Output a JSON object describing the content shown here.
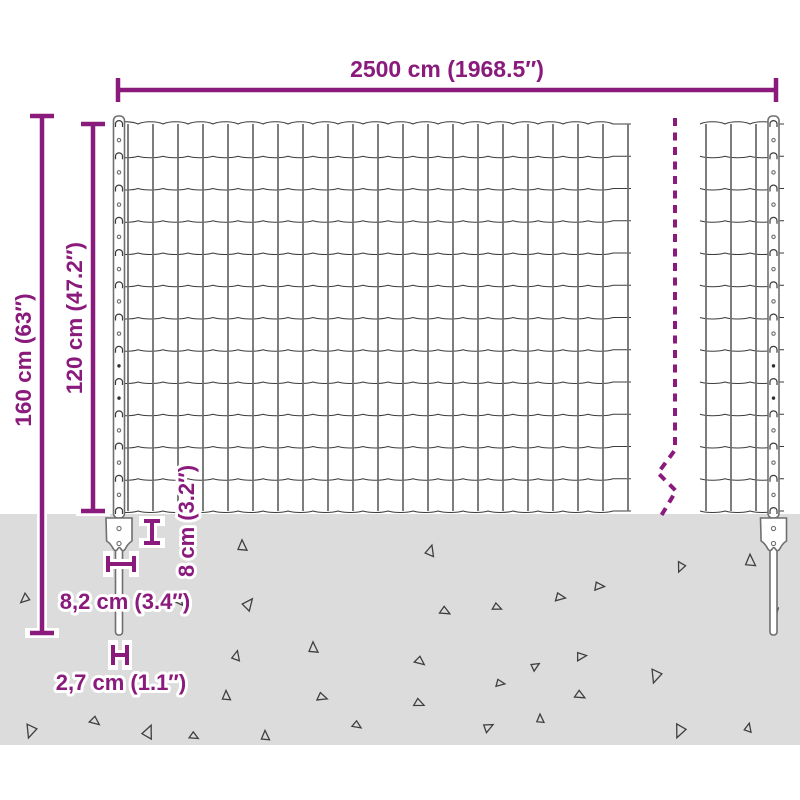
{
  "labels": {
    "width": "2500 cm (1968.5″)",
    "total_height": "160 cm (63″)",
    "fence_height": "120 cm (47.2″)",
    "anchor_height": "8 cm (3.2″)",
    "anchor_width": "8,2 cm (3.4″)",
    "post_width": "2,7 cm (1.1″)"
  },
  "colors": {
    "accent": "#8a1a7c",
    "ground": "#dcdcdc",
    "wire_dark": "#3c3c3c",
    "wire_light": "#6f6f6f",
    "triangle_outline": "#3f3f3f"
  },
  "diagram": {
    "ground": {
      "top": 514,
      "bottom": 745
    },
    "mesh": {
      "top": 124,
      "bottom": 511,
      "rows": 12,
      "cell_width": 25,
      "left": {
        "start": 113,
        "end": 631,
        "first_vertical": 128,
        "vertical_count": 21
      },
      "right": {
        "start": 700,
        "end": 784,
        "verticals": [
          706,
          731,
          756
        ]
      }
    },
    "posts": {
      "centers": [
        119,
        773.5
      ],
      "width": 11,
      "top": 116,
      "above_ground_bottom": 518,
      "spike_top": 540,
      "spike_bottom": 635,
      "spike_width": 7,
      "plate_top": 518,
      "plate_half_width": 13,
      "filled_hole_rows": [
        7,
        8
      ]
    },
    "break_line": {
      "points": "675,118 675,450 658,473 676,491 661,516",
      "dash": "8 6.5"
    },
    "triangles": [
      [
        242,
        546,
        10,
        0
      ],
      [
        430,
        551,
        10,
        18
      ],
      [
        681,
        567,
        9,
        205
      ],
      [
        750,
        561,
        11,
        0
      ],
      [
        599,
        586,
        9,
        95
      ],
      [
        560,
        597,
        9,
        100
      ],
      [
        25,
        599,
        9,
        230
      ],
      [
        248,
        604,
        11,
        40
      ],
      [
        445,
        611,
        9,
        120
      ],
      [
        497,
        607,
        8,
        115
      ],
      [
        180,
        602,
        7,
        140
      ],
      [
        236,
        656,
        9,
        15
      ],
      [
        313,
        648,
        10,
        0
      ],
      [
        420,
        661,
        9,
        130
      ],
      [
        535,
        666,
        8,
        60
      ],
      [
        581,
        656,
        9,
        85
      ],
      [
        656,
        676,
        12,
        200
      ],
      [
        500,
        683,
        8,
        100
      ],
      [
        226,
        696,
        9,
        0
      ],
      [
        322,
        697,
        9,
        110
      ],
      [
        419,
        703,
        9,
        115
      ],
      [
        580,
        695,
        9,
        120
      ],
      [
        680,
        731,
        12,
        205
      ],
      [
        31,
        731,
        12,
        200
      ],
      [
        95,
        721,
        9,
        130
      ],
      [
        148,
        732,
        12,
        25
      ],
      [
        194,
        736,
        8,
        120
      ],
      [
        265,
        736,
        9,
        0
      ],
      [
        357,
        725,
        8,
        125
      ],
      [
        488,
        727,
        9,
        65
      ],
      [
        540,
        719,
        8,
        0
      ],
      [
        748,
        728,
        8,
        15
      ],
      [
        775,
        612,
        8,
        40
      ]
    ]
  }
}
